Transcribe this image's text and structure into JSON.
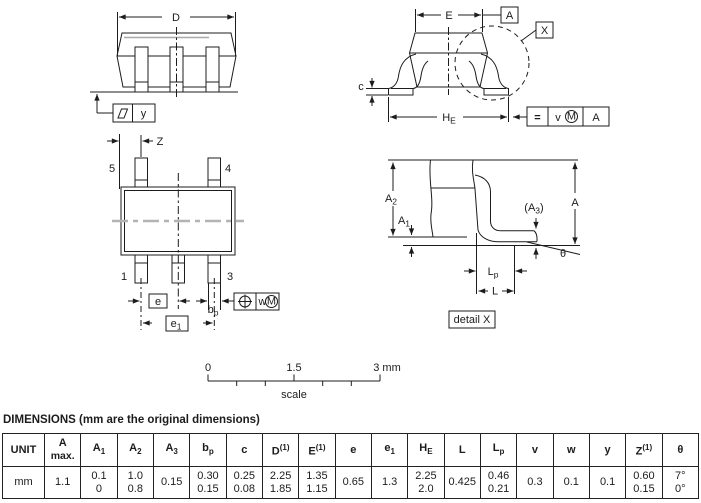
{
  "drawings": {
    "side_view": {
      "dim_D": "D",
      "flatness_datum": "y"
    },
    "front_view": {
      "dim_E": "E",
      "datum_A": "A",
      "detail_ref": "X",
      "dim_c": "c",
      "dim_HE": {
        "base": "H",
        "sub": "E"
      },
      "tol_frame": {
        "sym": "=",
        "tol": "v",
        "modifier": "M",
        "datum": "A"
      }
    },
    "top_view": {
      "dim_Z": "Z",
      "pin5": "5",
      "pin4": "4",
      "pin1": "1",
      "pin3": "3",
      "dim_e": "e",
      "dim_e1": {
        "base": "e",
        "sub": "1"
      },
      "dim_bp": {
        "base": "b",
        "sub": "p"
      },
      "tol_frame": {
        "tol": "w",
        "modifier": "M"
      }
    },
    "detail_x": {
      "dim_A2": {
        "base": "A",
        "sub": "2"
      },
      "dim_A1": {
        "base": "A",
        "sub": "1"
      },
      "dim_A3": {
        "pre": "(A",
        "sub": "3",
        "post": ")"
      },
      "dim_A": "A",
      "dim_Lp": {
        "base": "L",
        "sub": "p"
      },
      "dim_L": "L",
      "dim_theta": "θ",
      "caption": "detail X"
    },
    "scale_bar": {
      "tick0": "0",
      "tick1": "1.5",
      "tick2": "3 mm",
      "label": "scale"
    }
  },
  "table": {
    "heading": "DIMENSIONS (mm are the original dimensions)",
    "headers": [
      {
        "base": "UNIT"
      },
      {
        "base": "A",
        "line2": "max."
      },
      {
        "base": "A",
        "sub": "1"
      },
      {
        "base": "A",
        "sub": "2"
      },
      {
        "base": "A",
        "sub": "3"
      },
      {
        "base": "b",
        "sub": "p"
      },
      {
        "base": "c"
      },
      {
        "base": "D",
        "sup": "(1)"
      },
      {
        "base": "E",
        "sup": "(1)"
      },
      {
        "base": "e"
      },
      {
        "base": "e",
        "sub": "1"
      },
      {
        "base": "H",
        "sub": "E"
      },
      {
        "base": "L"
      },
      {
        "base": "L",
        "sub": "p"
      },
      {
        "base": "v"
      },
      {
        "base": "w"
      },
      {
        "base": "y"
      },
      {
        "base": "Z",
        "sup": "(1)"
      },
      {
        "base": "θ"
      }
    ],
    "row": [
      [
        "mm"
      ],
      [
        "1.1"
      ],
      [
        "0.1",
        "0"
      ],
      [
        "1.0",
        "0.8"
      ],
      [
        "0.15"
      ],
      [
        "0.30",
        "0.15"
      ],
      [
        "0.25",
        "0.08"
      ],
      [
        "2.25",
        "1.85"
      ],
      [
        "1.35",
        "1.15"
      ],
      [
        "0.65"
      ],
      [
        "1.3"
      ],
      [
        "2.25",
        "2.0"
      ],
      [
        "0.425"
      ],
      [
        "0.46",
        "0.21"
      ],
      [
        "0.3"
      ],
      [
        "0.1"
      ],
      [
        "0.1"
      ],
      [
        "0.60",
        "0.15"
      ],
      [
        "7°",
        "0°"
      ]
    ]
  }
}
